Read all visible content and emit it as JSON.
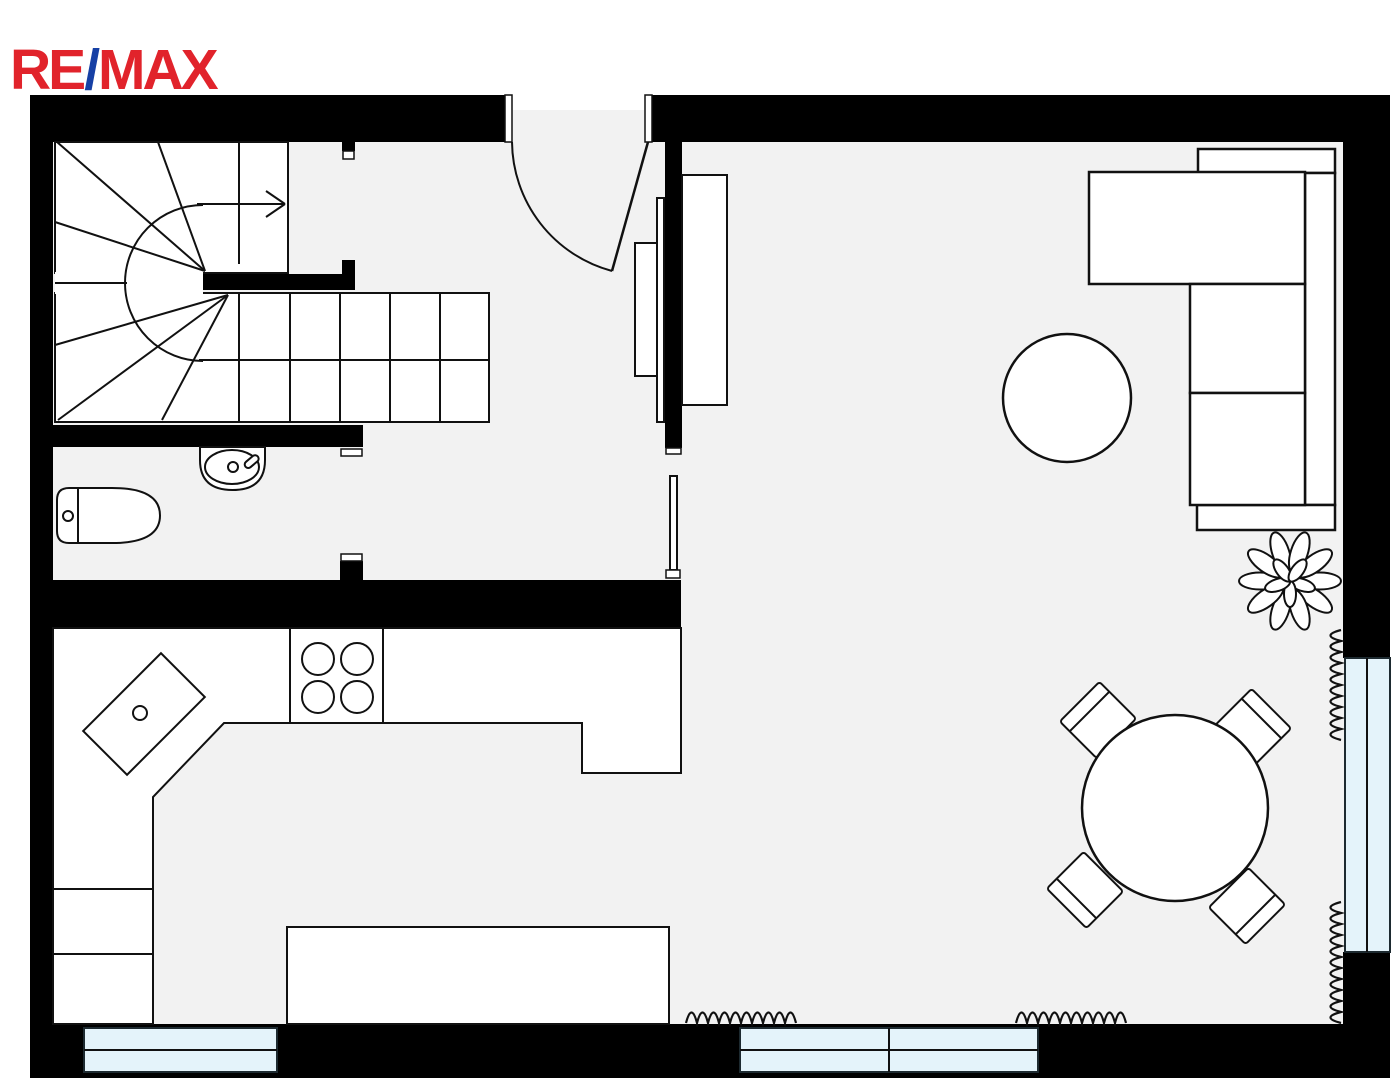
{
  "branding": {
    "re": "RE",
    "slash": "/",
    "max": "MAX",
    "red": "#e1232b",
    "blue": "#1640a5"
  },
  "colors": {
    "wall": "#000000",
    "floor": "#f2f2f2",
    "fixture": "#ffffff",
    "outline": "#111111",
    "window": "#e4f3fa",
    "background": "#ffffff"
  },
  "floor_plan": {
    "rooms": [
      {
        "name": "entry-hall"
      },
      {
        "name": "staircase-room"
      },
      {
        "name": "bathroom"
      },
      {
        "name": "kitchen"
      },
      {
        "name": "living-dining-room"
      }
    ],
    "openings": [
      {
        "name": "entry-door",
        "type": "swing-door",
        "location": "top-wall"
      },
      {
        "name": "interior-door",
        "type": "swing-door",
        "location": "hall-to-living"
      },
      {
        "name": "bathroom-doorway",
        "type": "opening",
        "location": "bathroom-right-wall"
      },
      {
        "name": "stair-doorway",
        "type": "opening",
        "location": "stair-right-wall"
      }
    ],
    "windows": [
      {
        "name": "window-bottom-left",
        "panes": 2
      },
      {
        "name": "window-bottom-middle",
        "panes": 4
      },
      {
        "name": "window-right",
        "panes": 2
      }
    ],
    "heating": [
      {
        "name": "radiator-bottom-left"
      },
      {
        "name": "radiator-bottom-middle"
      },
      {
        "name": "radiator-right-upper"
      },
      {
        "name": "radiator-right-lower"
      }
    ],
    "fixtures": [
      {
        "name": "toilet",
        "room": "bathroom"
      },
      {
        "name": "wash-basin",
        "room": "bathroom"
      },
      {
        "name": "kitchen-counter",
        "room": "kitchen"
      },
      {
        "name": "corner-sink",
        "room": "kitchen"
      },
      {
        "name": "cooktop",
        "room": "kitchen",
        "burners": 4
      },
      {
        "name": "kitchen-island",
        "room": "kitchen"
      },
      {
        "name": "staircase",
        "type": "winder",
        "direction_arrow": "up"
      }
    ],
    "furniture": [
      {
        "name": "sectional-sofa",
        "room": "living-dining-room"
      },
      {
        "name": "coffee-table",
        "shape": "round"
      },
      {
        "name": "tv-sideboard"
      },
      {
        "name": "sliding-door-panel"
      },
      {
        "name": "hall-cabinet"
      },
      {
        "name": "dining-table",
        "shape": "round",
        "chairs": 4
      },
      {
        "name": "potted-plant"
      }
    ]
  }
}
